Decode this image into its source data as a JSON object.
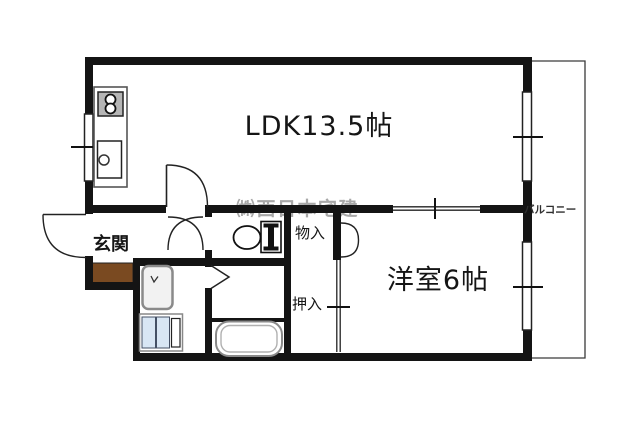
{
  "plan": {
    "rooms": {
      "ldk": "LDK13.5帖",
      "western_room": "洋室6帖",
      "entrance": "玄関",
      "storage": "物入",
      "closet": "押入",
      "balcony": "バルコニー"
    },
    "watermark": "㈱西日本宅建",
    "colors": {
      "wall": "#141414",
      "entrance_step": "#7a4a21",
      "laundry_pan": "#d8e6f4",
      "watermark_gray": "#a8a8a8",
      "background": "#ffffff"
    },
    "fixtures": {
      "stove": "stove-icon",
      "sink": "kitchen-sink-icon",
      "toilet": "toilet-icon",
      "bathtub": "bathtub-icon",
      "washbasin": "washbasin-icon",
      "laundry_pan": "washing-machine-pan-icon"
    }
  }
}
